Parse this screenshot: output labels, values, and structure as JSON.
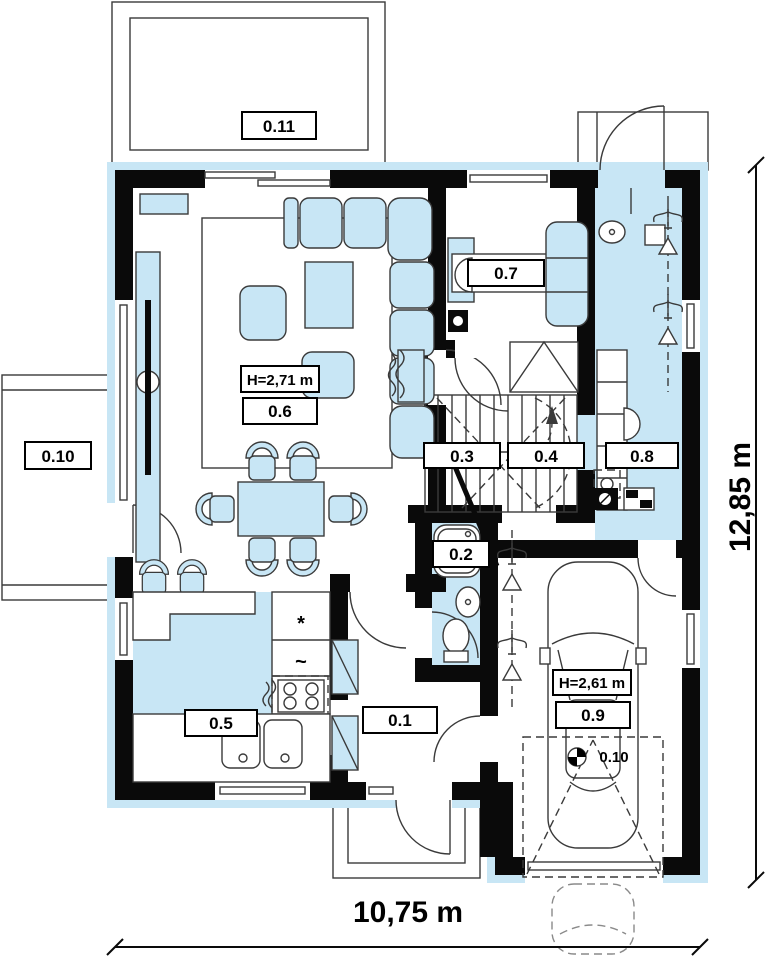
{
  "plan": {
    "rooms": {
      "r0_1": "0.1",
      "r0_2": "0.2",
      "r0_3": "0.3",
      "r0_4": "0.4",
      "r0_5": "0.5",
      "r0_6": "0.6",
      "r0_7": "0.7",
      "r0_8": "0.8",
      "r0_9": "0.9",
      "r0_10_terrace": "0.10",
      "r0_10_parking": "0.10",
      "r0_11": "0.11"
    },
    "heights": {
      "living": "H=2,71 m",
      "garage": "H=2,61 m"
    },
    "dimensions": {
      "width": "10,75 m",
      "depth": "12,85 m"
    },
    "symbols": {
      "fridge": "*",
      "dishwasher": "~"
    },
    "colors": {
      "accent_fill": "#c8e6f5",
      "wall": "#0a0a0a",
      "line": "#3a3a3a"
    }
  }
}
